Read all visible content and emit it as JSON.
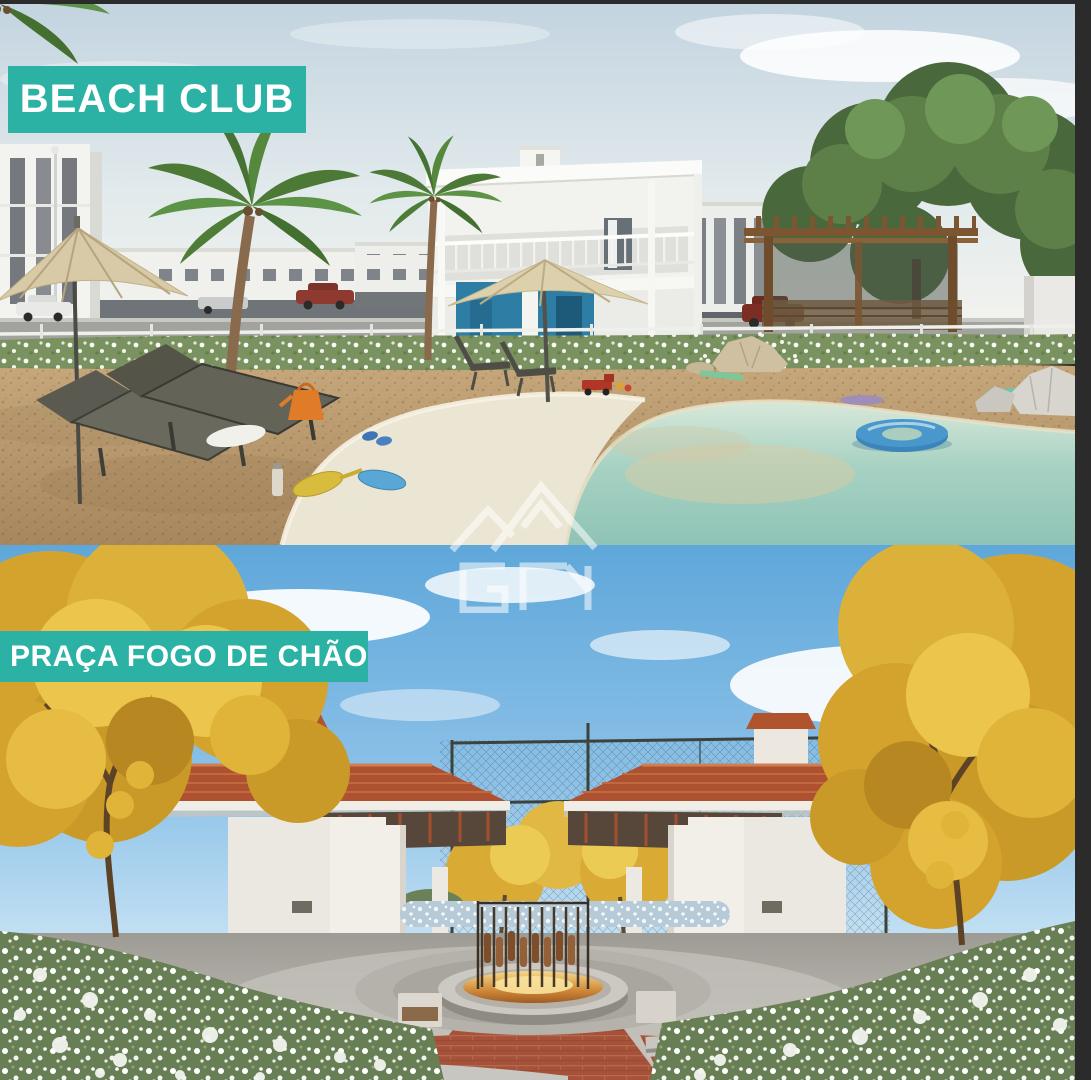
{
  "theme": {
    "banner_color": "#2cb1a5",
    "banner_text_color": "#ffffff",
    "frame_color": "#2b2b2b",
    "watermark_color": "#ffffff"
  },
  "sections": {
    "beach_club": {
      "label": "BEACH CLUB"
    },
    "praca_fogo_de_chao": {
      "label": "PRAÇA FOGO DE CHÃO"
    }
  },
  "watermark": {
    "icon": "gm-monogram-watermark"
  }
}
